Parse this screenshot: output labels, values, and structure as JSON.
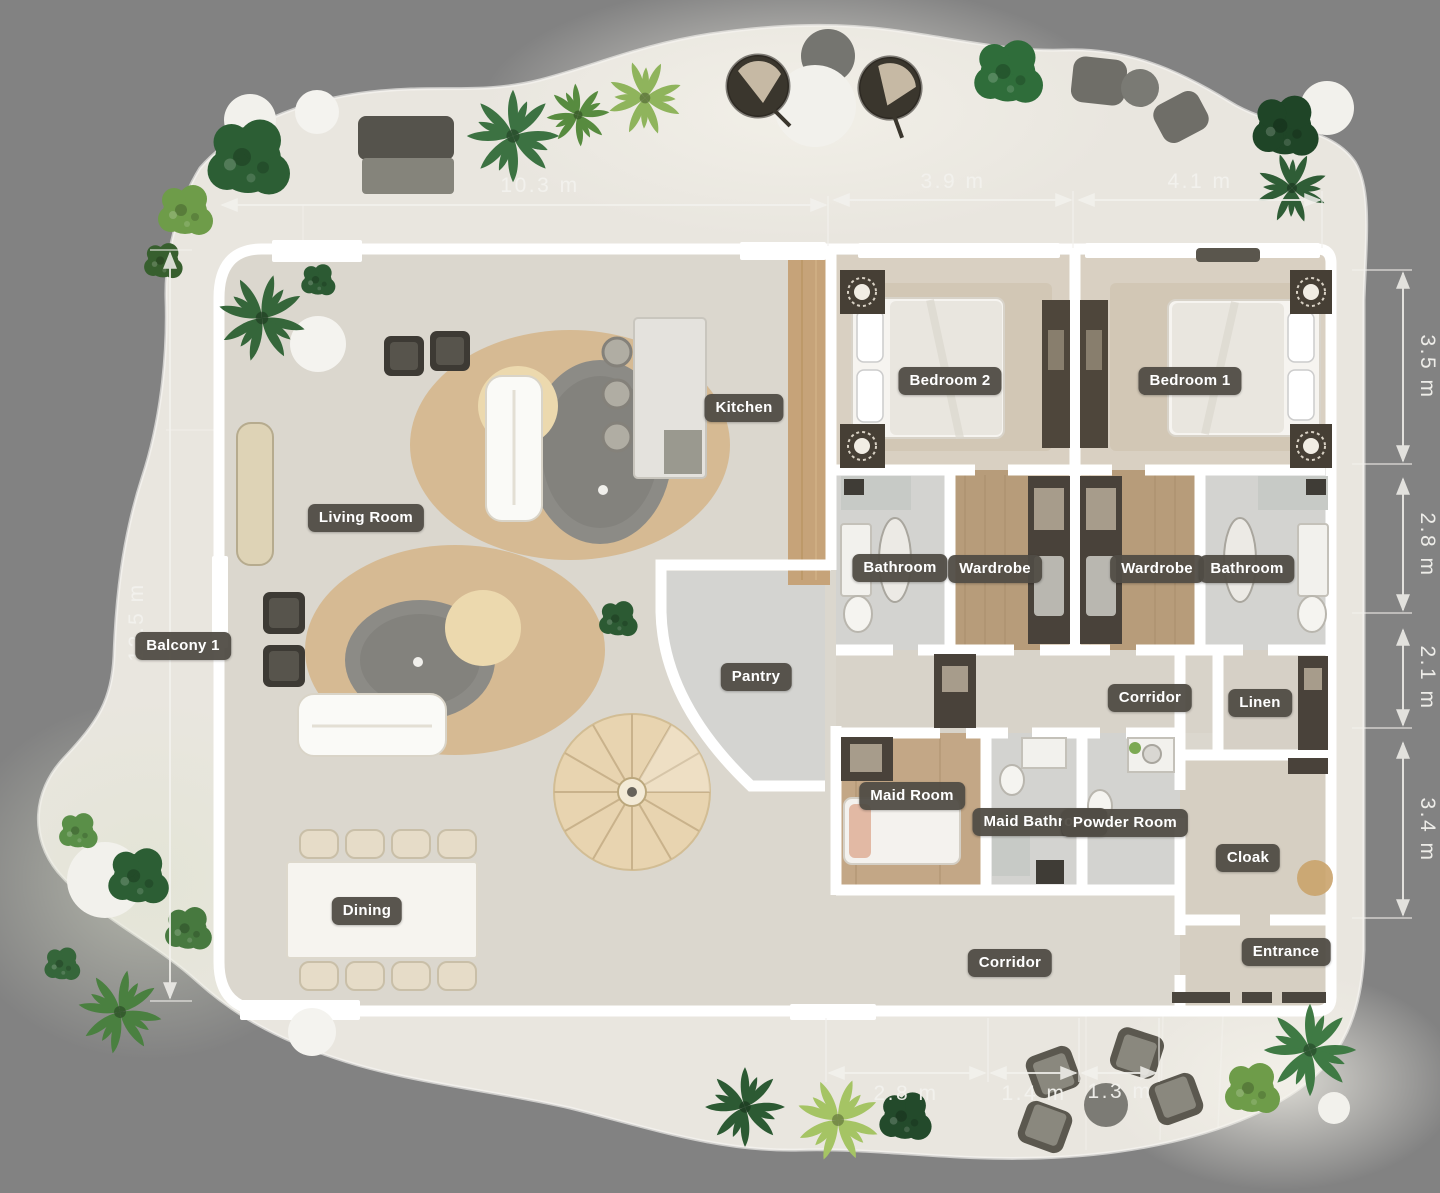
{
  "plan": {
    "rooms": {
      "living_room": {
        "label": "Living Room"
      },
      "kitchen": {
        "label": "Kitchen"
      },
      "bedroom_2": {
        "label": "Bedroom 2"
      },
      "bedroom_1": {
        "label": "Bedroom 1"
      },
      "bathroom_left": {
        "label": "Bathroom"
      },
      "wardrobe_left": {
        "label": "Wardrobe"
      },
      "wardrobe_right": {
        "label": "Wardrobe"
      },
      "bathroom_right": {
        "label": "Bathroom"
      },
      "pantry": {
        "label": "Pantry"
      },
      "corridor_upper": {
        "label": "Corridor"
      },
      "linen": {
        "label": "Linen"
      },
      "maid_room": {
        "label": "Maid Room"
      },
      "maid_bathroom": {
        "label": "Maid Bathroom"
      },
      "powder_room": {
        "label": "Powder Room"
      },
      "cloak": {
        "label": "Cloak"
      },
      "entrance": {
        "label": "Entrance"
      },
      "corridor_lower": {
        "label": "Corridor"
      },
      "dining": {
        "label": "Dining"
      },
      "balcony_1": {
        "label": "Balcony 1"
      }
    },
    "dimensions": {
      "top_w1": "10.3 m",
      "top_w2": "3.9 m",
      "top_w3": "4.1 m",
      "right_h1": "3.5 m",
      "right_h2": "2.8 m",
      "right_h3": "2.1 m",
      "right_h4": "3.4 m",
      "left_h1": "12.5 m",
      "bottom_w1": "2.8 m",
      "bottom_w2": "1.4 m",
      "bottom_w3": "1.3 m"
    },
    "palette": {
      "background": "#828282",
      "terrace": "#e9e6df",
      "floor": "#dbd7ce",
      "wall": "#ffffff",
      "wood_floor": "#b79c7a",
      "wood_wall": "#c6a379",
      "rug": "#d5b588",
      "label_bg": "#504c44",
      "label_text": "#ffffff",
      "dimension_text": "#f3f2ee",
      "plant_dark": "#2c5a33",
      "plant_light": "#a5c464"
    }
  }
}
